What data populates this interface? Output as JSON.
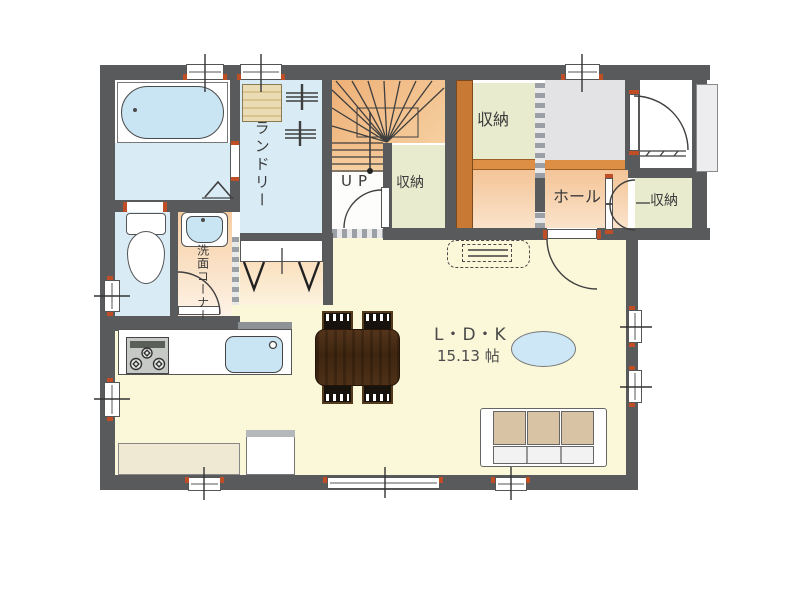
{
  "plan": {
    "rooms": {
      "laundry": {
        "label": "ランドリー"
      },
      "washroom": {
        "label": "洗面コーナー"
      },
      "hall": {
        "label": "ホール"
      },
      "stairs": {
        "label": "UP"
      },
      "closet_by_stairs": {
        "label": "収納"
      },
      "closet_upper": {
        "label": "収納"
      },
      "closet_entry": {
        "label": "収納"
      },
      "ldk": {
        "name": "L・D・K",
        "size": "15.13 帖"
      }
    },
    "colors": {
      "wall": "#595a5c",
      "water_floor": "#d9ecf6",
      "fixture_blue": "#c9e4f3",
      "ldk_floor": "#fbf8da",
      "stair_orange": "#eeb077",
      "wood_wall": "#c87a35",
      "step_strip": "#dd8f45",
      "closet_green": "#e9ebce",
      "hall_orange": "#f4c497",
      "entry_gray": "#e3e3e5",
      "sofa_tan": "#d8c3a5",
      "table_brown": "#4a2d14",
      "tv_board": "#efe9d4",
      "door_jamb": "#bf4e26"
    }
  }
}
